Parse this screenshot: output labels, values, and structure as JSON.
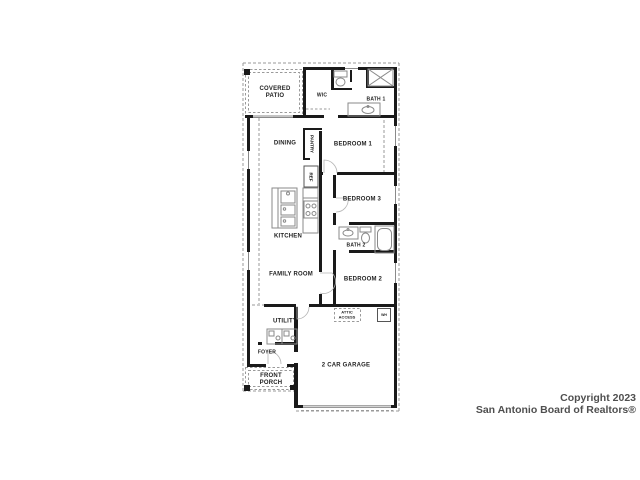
{
  "rooms": {
    "covered_patio": "COVERED\nPATIO",
    "wic": "WIC",
    "bath1": "BATH 1",
    "dining": "DINING",
    "pantry": "PANTRY",
    "bedroom1": "BEDROOM 1",
    "ref": "REF",
    "kitchen": "KITCHEN",
    "bedroom3": "BEDROOM 3",
    "bath2": "BATH 2",
    "family_room": "FAMILY ROOM",
    "bedroom2": "BEDROOM 2",
    "utility": "UTILITY",
    "attic_access": "ATTIC\nACCESS",
    "wh": "WH",
    "foyer": "FOYER",
    "front_porch": "FRONT\nPORCH",
    "garage": "2 CAR GARAGE"
  },
  "copyright": {
    "line1": "Copyright 2023",
    "line2": "San Antonio Board of Realtors®"
  },
  "colors": {
    "background": "#ffffff",
    "wall": "#1a1a1a",
    "dashed": "#9a9a9a",
    "fixture": "#8a8a8a",
    "label": "#1f1f1f",
    "watermark": "#4f4f4f"
  }
}
